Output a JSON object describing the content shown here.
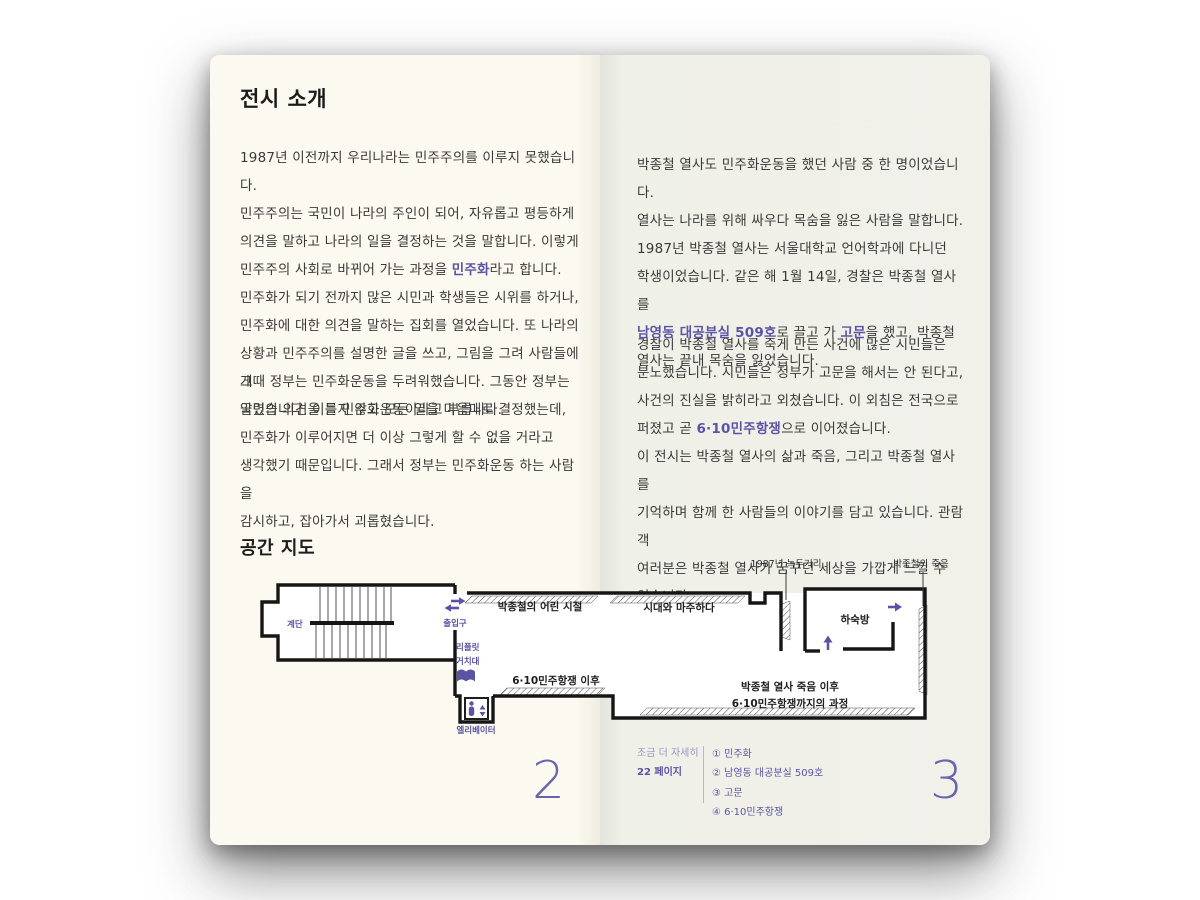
{
  "accent_color": "#5b54a6",
  "paper_color_left": "#fbf9f0",
  "paper_color_right": "#f1f1ea",
  "left_page": {
    "title": "전시 소개",
    "paragraphs": [
      [
        {
          "t": "1987년 이전까지 우리나라는 민주주의를 이루지 못했습니다.\n민주주의는 국민이 나라의 주인이 되어, 자유롭고 평등하게\n의견을 말하고 나라의 일을 결정하는 것을 말합니다. 이렇게\n민주주의 사회로 바뀌어 가는 과정을 "
        },
        {
          "t": "민주화",
          "hl": true
        },
        {
          "t": "라고 합니다.\n민주화가 되기 전까지 많은 시민과 학생들은 시위를 하거나,\n민주화에 대한 의견을 말하는 집회를 열었습니다. 또 나라의\n상황과 민주주의를 설명한 글을 쓰고, 그림을 그려 사람들에게\n알렸습니다. 이를 민주화운동이라고 부릅니다."
        }
      ],
      [
        {
          "t": "그때 정부는 민주화운동을 두려워했습니다. 그동안 정부는\n국민의 의견을 듣지 않고 모든 일을 마음대로 결정했는데,\n민주화가 이루어지면 더 이상 그렇게 할 수 없을 거라고\n생각했기 때문입니다. 그래서 정부는 민주화운동 하는 사람을\n감시하고, 잡아가서 괴롭혔습니다."
        }
      ]
    ],
    "map_title": "공간 지도",
    "page_number": "2"
  },
  "right_page": {
    "paragraphs": [
      [
        {
          "t": "박종철 열사도 민주화운동을 했던 사람 중 한 명이었습니다.\n열사는 나라를 위해 싸우다 목숨을 잃은 사람을 말합니다.\n1987년 박종철 열사는 서울대학교 언어학과에 다니던\n학생이었습니다. 같은 해 1월 14일, 경찰은 박종철 열사를\n"
        },
        {
          "t": "남영동 대공분실 509호",
          "hl": true
        },
        {
          "t": "로 끌고 가 "
        },
        {
          "t": "고문",
          "hl": true
        },
        {
          "t": "을 했고, 박종철\n열사는 끝내 목숨을 잃었습니다."
        }
      ],
      [
        {
          "t": "경찰이 박종철 열사를 죽게 만든 사건에 많은 시민들은\n분노했습니다. 시민들은 정부가 고문을 해서는 안 된다고,\n사건의 진실을 밝히라고 외쳤습니다. 이 외침은 전국으로\n퍼졌고 곧 "
        },
        {
          "t": "6·10민주항쟁",
          "hl": true
        },
        {
          "t": "으로 이어졌습니다.\n이 전시는 박종철 열사의 삶과 죽음, 그리고 박종철 열사를\n기억하며 함께 한 사람들의 이야기를 담고 있습니다. 관람객\n여러분은 박종철 열사가 꿈꾸던 세상을 가깝게 느낄 수\n있습니다."
        }
      ]
    ],
    "footer": {
      "more_label": "조금 더 자세히",
      "more_page": "22 페이지",
      "footnotes": [
        "① 민주화",
        "② 남영동 대공분실 509호",
        "③ 고문",
        "④ 6·10민주항쟁"
      ]
    },
    "page_number": "3"
  },
  "map": {
    "labels": {
      "stairs": "계단",
      "entrance": "출입구",
      "childhood": "박종철의 어린 시절",
      "facing_era": "시대와 마주하다",
      "leaflet_line1": "리플릿",
      "leaflet_line2": "거치대",
      "after_610": "6·10민주항쟁 이후",
      "elevator": "엘리베이터",
      "boarding_room": "하숙방",
      "after_death_line1": "박종철 열사 죽음 이후",
      "after_death_line2": "6·10민주항쟁까지의 과정",
      "callout_nokdu": "1987년 녹두거리",
      "callout_death": "박종철의 죽음"
    }
  }
}
